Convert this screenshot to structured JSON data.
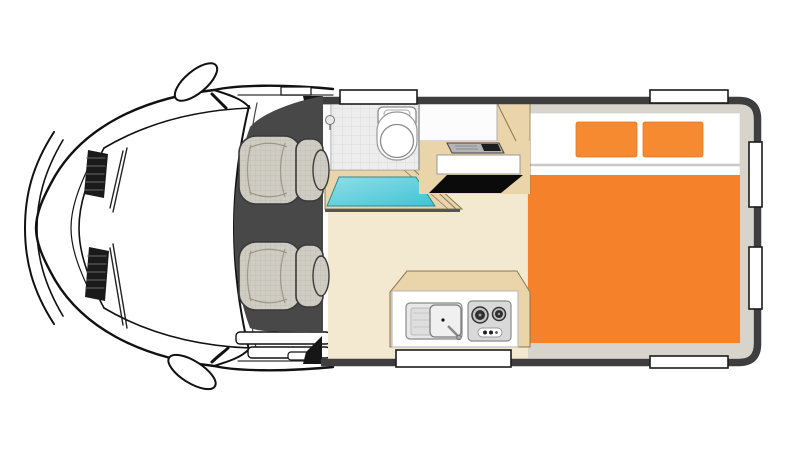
{
  "image": {
    "type": "vehicle-floorplan",
    "vehicle": "campervan-motorhome",
    "view": "top-down",
    "front_direction": "left"
  },
  "colors": {
    "van_line": "#111111",
    "cab_floor": "#484848",
    "seat": "#CFCCC3",
    "seat_line": "#3A3A3A",
    "cream_floor": "#F3E9D1",
    "beige": "#E9D5A9",
    "beige_edge": "#8A7753",
    "tile": "#EDEDED",
    "tile_line": "#DADADA",
    "cyan_light": "#92DEE7",
    "cyan_dark": "#3FC3D6",
    "cyan_edge": "#2E8A97",
    "orange": "#F5822A",
    "pillow_orange": "#F68A30",
    "wall": "#3E3E3E",
    "trim": "#D8D4CC",
    "white": "#FFFFFF",
    "black_opening": "#0B0B0B",
    "appliance": "#B5B5B5",
    "appliance_dark": "#1E1E1E",
    "stove": "#D9D9D9",
    "sink": "#E8E8E8",
    "window_frame": "#1C1C1C",
    "sheet_line": "#C8C8C8",
    "grille_dark": "#1A1A1A"
  },
  "cab": {
    "seats": 2,
    "side_mirrors": 2,
    "hood_vents": 2,
    "wipers": 2
  },
  "bathroom": {
    "floor": "tiled",
    "toilet": 1,
    "shower_tray": 1,
    "shower_head": 1
  },
  "galley_mid": {
    "parts": [
      "overhead-cabinet",
      "cooktop-console",
      "counter-front",
      "under-counter-opening",
      "wardrobe-column"
    ]
  },
  "galley_rear": {
    "sink_basins": 1,
    "drainboard": true,
    "faucet": true,
    "stove_burners": 2,
    "control_knobs": 3
  },
  "bed": {
    "pillows": 2,
    "mattress_color": "orange",
    "base_color": "white"
  },
  "openings": {
    "top_windows": 2,
    "right_windows": 2,
    "bottom_windows": 2
  }
}
